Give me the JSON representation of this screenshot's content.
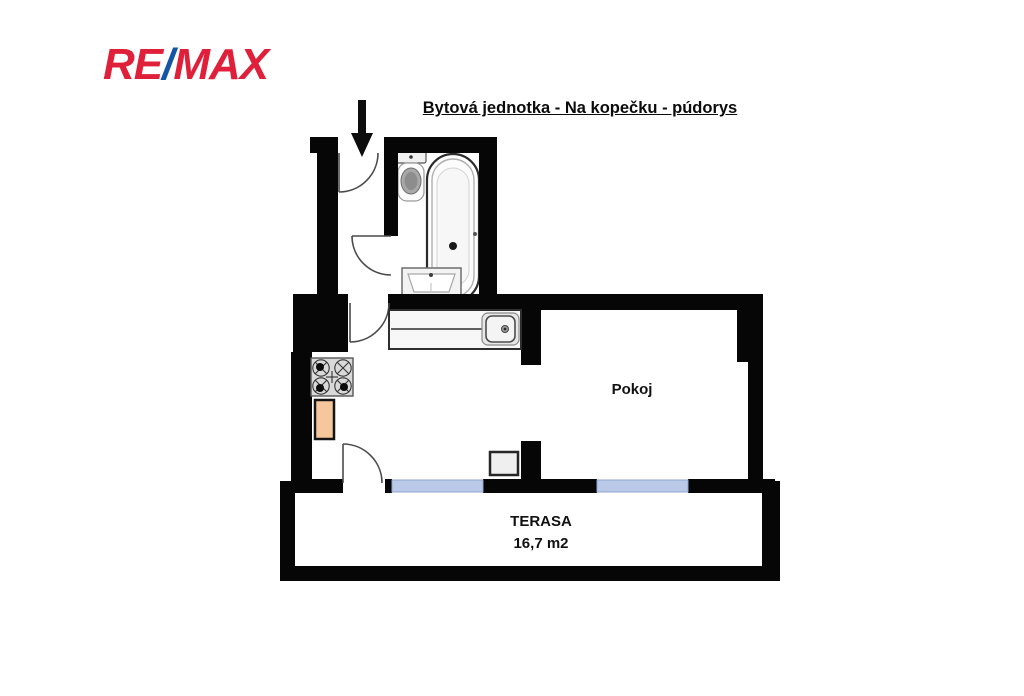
{
  "header": {
    "logo": {
      "part_re": "RE",
      "part_slash": "/",
      "part_max": "MAX"
    },
    "title": "Bytová jednotka - Na kopečku - púdorys"
  },
  "floorplan": {
    "room_label": "Pokoj",
    "terrace_label": "TERASA",
    "terrace_area": "16,7 m2"
  },
  "colors": {
    "brand_red": "#e0203a",
    "brand_blue": "#1456a5",
    "wall": "#060606",
    "window_glass": "#bac9e8",
    "window_edge": "#8fa6d2",
    "cabinet": "#f6c69c",
    "door_arc": "#4a4a4a"
  },
  "icons": {
    "entrance_arrow": "down-arrow",
    "fixture_names": [
      "bathtub",
      "toilet",
      "washbasin",
      "kitchen-sink",
      "stove",
      "cabinet",
      "furniture-block"
    ]
  }
}
